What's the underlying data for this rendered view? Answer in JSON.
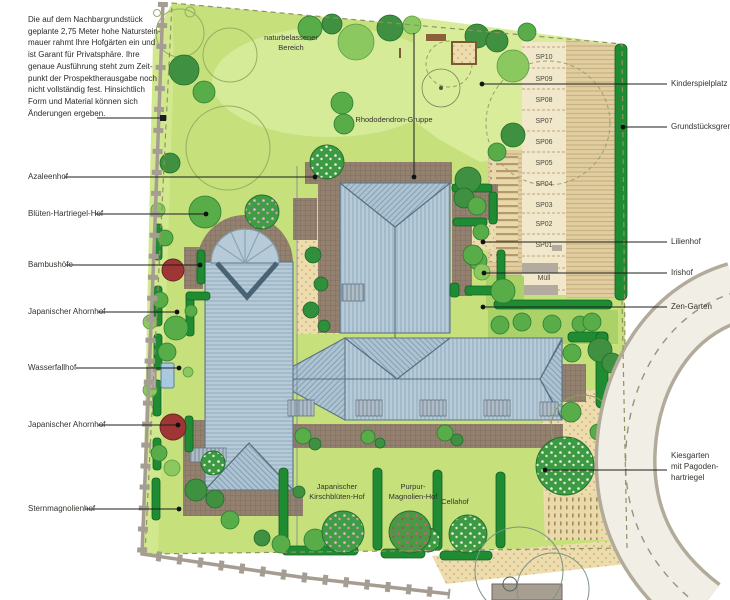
{
  "annotation": "Die auf dem Nachbargrundstück\ngeplante 2,75 Meter hohe Naturstein-\nmauer rahmt Ihre Hofgärten ein und\nist Garant für Privatsphäre. Ihre\ngenaue Ausführung steht zum Zeit-\npunkt der Prospektherausgabe noch\nnicht vollständig fest. Hinsichtlich\nForm und Material können sich\nÄnderungen ergeben.",
  "left_labels": [
    "Azaleenhof",
    "Blüten-Hartriegel-Hof",
    "Bambushöfe",
    "Japanischer Ahornhof",
    "Wasserfallhof",
    "Japanischer Ahornhof",
    "Sternmagnolienhof"
  ],
  "right_labels": [
    "Kinderspielplatz",
    "Grundstücksgrenze",
    "Lilienhof",
    "Irishof",
    "Zen-Garten"
  ],
  "kiesgarten_label": "Kiesgarten\nmit Pagoden-\nhartriegel",
  "center_labels": {
    "natural_area": "naturbelassener\nBereich",
    "rhododendron": "Rhododendron-Gruppe",
    "cherry_court": "Japanischer\nKirschblüten-Hof",
    "magnolia_court": "Purpur-\nMagnolien-Hof",
    "cella_court": "Cellahof"
  },
  "parking": {
    "spots": [
      "SP10",
      "SP09",
      "SP08",
      "SP07",
      "SP06",
      "SP05",
      "SP04",
      "SP03",
      "SP02",
      "SP01"
    ],
    "waste": "Müll"
  },
  "colors": {
    "lawn": "#c6e07c",
    "lawn_light": "#d5eb97",
    "roof": "#b6cad7",
    "paving": "#93806e",
    "parking_stripe": "#e0cda0",
    "sand": "#ecdcae",
    "hedge": "#1f8c33",
    "tree_dark": "#3f9040",
    "tree_red": "#9e3636",
    "road": "#f1eee6",
    "wall": "#a59d92",
    "leader": "#1c1c1c"
  }
}
